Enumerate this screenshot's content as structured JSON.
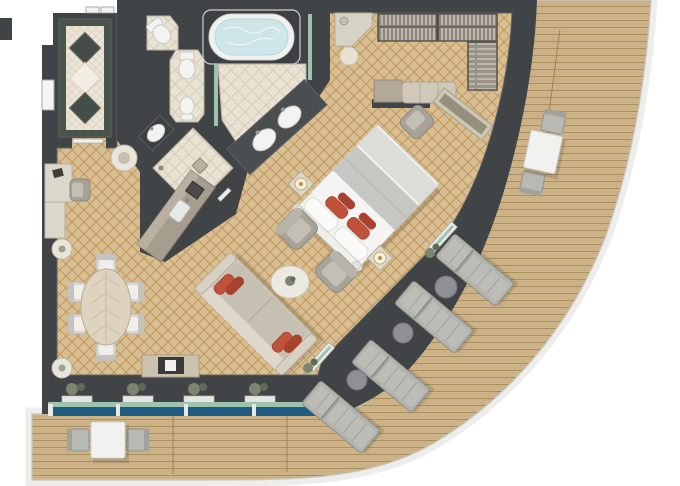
{
  "meta": {
    "title": "Luxury suite floor plan with curved veranda",
    "type": "floor-plan"
  },
  "palette": {
    "outside": "#ffffff",
    "wall": "#404446",
    "wallEdge": "#5d6163",
    "carpet": "#d8be93",
    "carpetLine": "#c3985b",
    "tile": "#e9e2d2",
    "tileLine": "#d6ccb8",
    "entryDiamondDark": "#454d48",
    "deck": "#cdb287",
    "deckLine": "#a8905f",
    "rail": "#ededeb",
    "railEdge": "#c6c6c4",
    "glassBlue": "#1e5c84",
    "glassGreen": "#9ec4b0",
    "water": "#cfe6e8",
    "white": "#f3f3f1",
    "gray": "#a7a399",
    "wood": "#ddd3bf",
    "marbleDark": "#4b534d",
    "red": "#c0513a",
    "redDark": "#a8422e",
    "plant": "#7d8570",
    "plantDark": "#5f6a58",
    "lounger": "#b4b4ae",
    "loungerEdge": "#8e8e88",
    "counter": "#a79d8e",
    "counterEdge": "#857c6d"
  },
  "plan": {
    "suite_label": "Owner's suite floor plan",
    "deck_label": "Curved teak veranda",
    "rooms": [
      {
        "name": "entry-hall",
        "floor": "marble with diamond inlays"
      },
      {
        "name": "bathroom",
        "fixtures": [
          "oval-bathtub",
          "double-sink-vanity",
          "toilet",
          "toilet",
          "bidet",
          "washbasin"
        ]
      },
      {
        "name": "shower-room",
        "fixtures": [
          "walk-in-shower",
          "floor-drain"
        ]
      },
      {
        "name": "wet-bar",
        "fixtures": [
          "bar-counter",
          "bar-sink",
          "espresso-machine"
        ]
      },
      {
        "name": "walk-in-closet",
        "fixtures": [
          "hanging-rails",
          "shelf-tower",
          "dresser-bench",
          "vanity",
          "stool"
        ]
      },
      {
        "name": "bedroom",
        "fixtures": [
          "king-bed",
          "nightstand",
          "nightstand",
          "table-lamp",
          "table-lamp",
          "desk",
          "desk-chair",
          "media-console"
        ]
      },
      {
        "name": "living-room",
        "fixtures": [
          "sofa",
          "coffee-table",
          "armchair",
          "armchair",
          "tv-console",
          "writing-desk",
          "desk-chair",
          "side-table",
          "pedestal-table",
          "pedestal-table"
        ]
      },
      {
        "name": "dining-area",
        "fixtures": [
          "oval-dining-table",
          "dining-chairs-x6"
        ]
      },
      {
        "name": "veranda",
        "fixtures": [
          "sun-loungers-x4",
          "round-side-tables-x3",
          "al-fresco-table-sets-x2",
          "whirlpool-view-railing"
        ]
      }
    ],
    "counts": {
      "dining_chairs": 6,
      "sun_loungers": 4,
      "deck_side_tables": 3,
      "deck_table_sets": 2,
      "bathroom_sinks": 2,
      "toilets": 2,
      "bidets": 1,
      "bathtubs": 1,
      "beds": 1,
      "sofas": 1,
      "armchairs": 2,
      "red_accent_pillows": 6,
      "window_planters": 4
    }
  }
}
